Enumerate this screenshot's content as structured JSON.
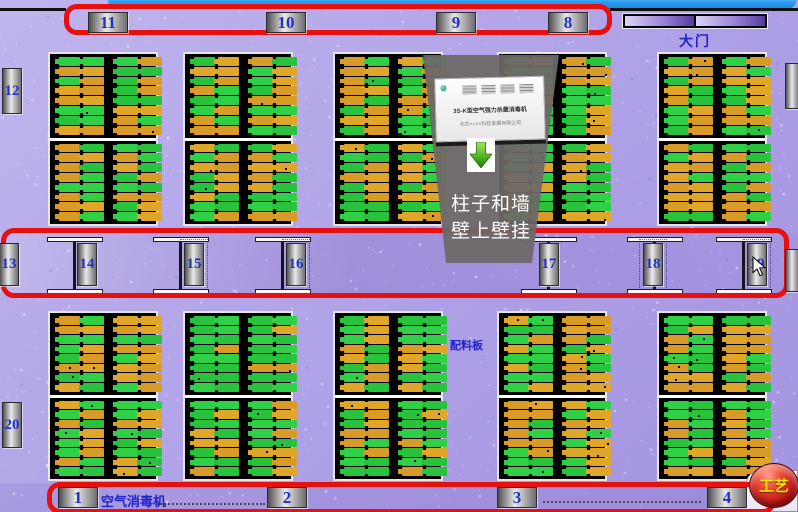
{
  "labels": {
    "door": "大门",
    "material_board": "配料板",
    "air_sterilizer": "空气消毒机",
    "process_button": "工艺"
  },
  "callout": {
    "product_title": "3S-K型空气强力杀菌消毒机",
    "product_company": "北京××××科技发展有限公司",
    "line1": "柱子和墙",
    "line2": "壁上壁挂",
    "arrow_icon": "down-arrow"
  },
  "plaques": {
    "top_row": [
      "11",
      "10",
      "9",
      "8"
    ],
    "left_wall": [
      "12",
      "20"
    ],
    "corridor": [
      "13",
      "14",
      "15",
      "16",
      "17",
      "18",
      "19"
    ],
    "bottom_row": [
      "1",
      "2",
      "3",
      "4"
    ]
  },
  "racks": {
    "section_count": 2,
    "racks_per_section": 5,
    "tray_columns_per_rack": 4,
    "trays_per_column": 16
  },
  "colors": {
    "outline_red": "#e80f0f",
    "plaque_number_blue": "#2230c8",
    "rack_green": "#2fd046",
    "rack_orange": "#e0a62a",
    "button_red": "#b01010",
    "button_label_yellow": "#ffe400",
    "background_purple": "#b0a3e6",
    "window_edge_blue": "#2e9bf0"
  }
}
